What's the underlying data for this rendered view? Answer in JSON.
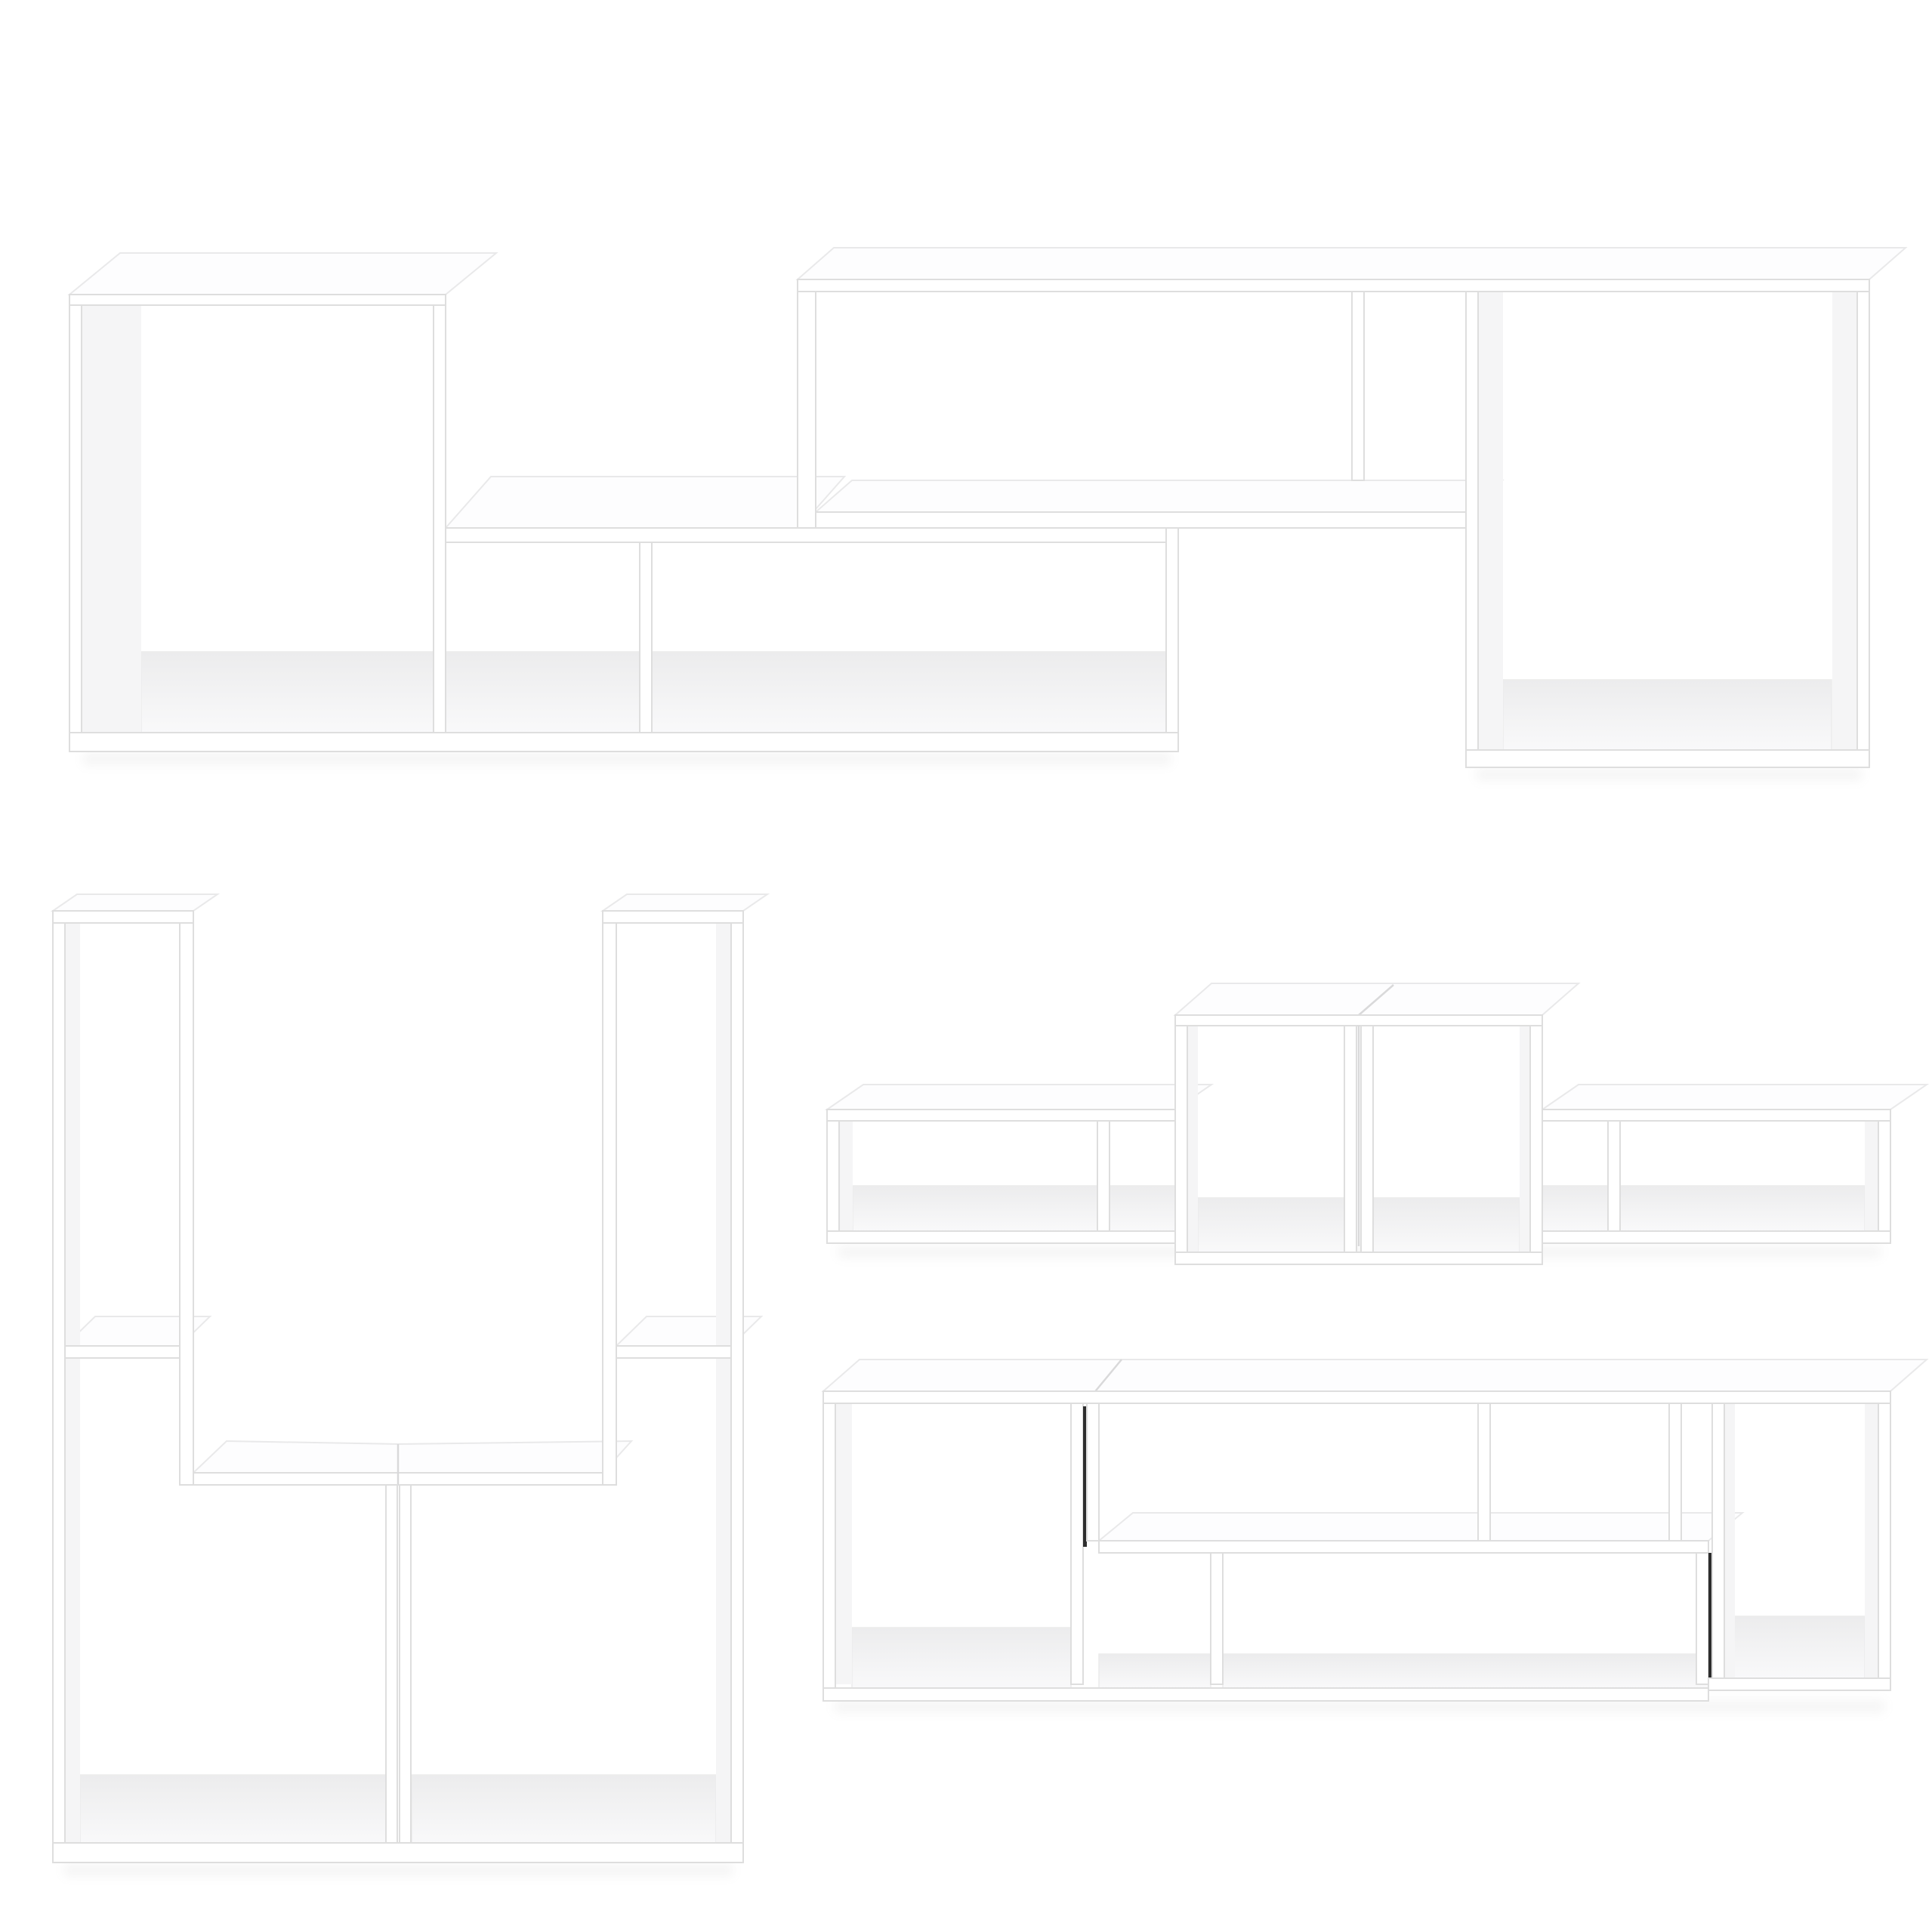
{
  "page": {
    "background_color": "#ffffff",
    "description": "Product photo collage of a two-piece white L-shaped modular shelving set shown in four different assembly configurations on a plain white background",
    "text_content": "none"
  },
  "product": {
    "material_color": "#ffffff",
    "edge_line_color": "#dedede",
    "interior_shading_color": "#f0f0f1",
    "junction_seam_color": "#2e2e2e",
    "pieces_per_set": 2
  },
  "figures": [
    {
      "id": "tv-stand-long",
      "position": "top",
      "label": "Two L-shaped shelf units interlocked horizontally into a long low TV stand with staggered open compartments",
      "open_compartments": 6
    },
    {
      "id": "tall-vertical-unit",
      "position": "bottom-left",
      "label": "Two L-shaped shelf units stood upright and joined into a tall symmetric shelving tower with twin top columns and a wide two-bay base",
      "open_compartments": 6
    },
    {
      "id": "podium-shelf",
      "position": "middle-right",
      "label": "Two L-shaped shelf units arranged into a stepped podium shelf with a raised center tower and low side wings",
      "open_compartments": 8
    },
    {
      "id": "compact-s-unit",
      "position": "bottom-right",
      "label": "Two L-shaped shelf units nested into a compact rectangular cabinet with an S-shaped internal shelf and visible dark junction seams",
      "open_compartments": 6
    }
  ]
}
